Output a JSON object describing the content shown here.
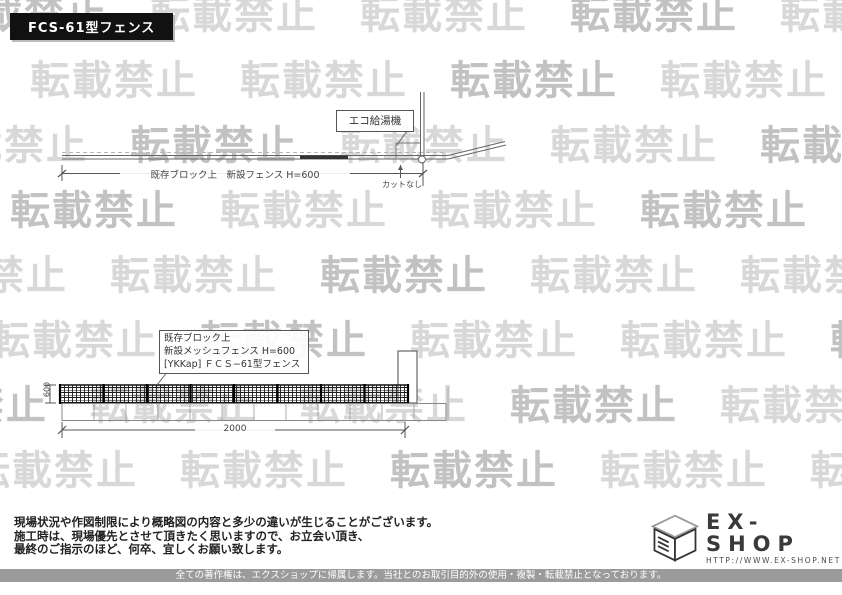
{
  "title_badge": "FCS-61型フェンス",
  "watermark": {
    "text": "転載禁止"
  },
  "plan_view": {
    "heater_label": "エコ給湯機",
    "dimension_label": "既存ブロック上　新設フェンス H=600",
    "cut_label": "カットなし"
  },
  "elevation_view": {
    "spec_box": {
      "line1": "既存ブロック上",
      "line2": "新設メッシュフェンス H=600",
      "line3": "[YKKap] ＦＣＳ−61型フェンス"
    },
    "height_dim": "600",
    "width_dim": "2000"
  },
  "notes": {
    "line1": "現場状況や作図制限により概略図の内容と多少の違いが生じることがございます。",
    "line2": "施工時は、現場優先とさせて頂きたく思いますので、お立会い頂き、",
    "line3": "最終のご指示のほど、何卒、宜しくお願い致します。"
  },
  "logo": {
    "name": "EX-SHOP",
    "url": "HTTP://WWW.EX-SHOP.NET",
    "contact": "担当:堀"
  },
  "footer": "全ての著作権は、エクスショップに帰属します。当社とのお取引目的外の使用・複製・転載禁止となっております。"
}
